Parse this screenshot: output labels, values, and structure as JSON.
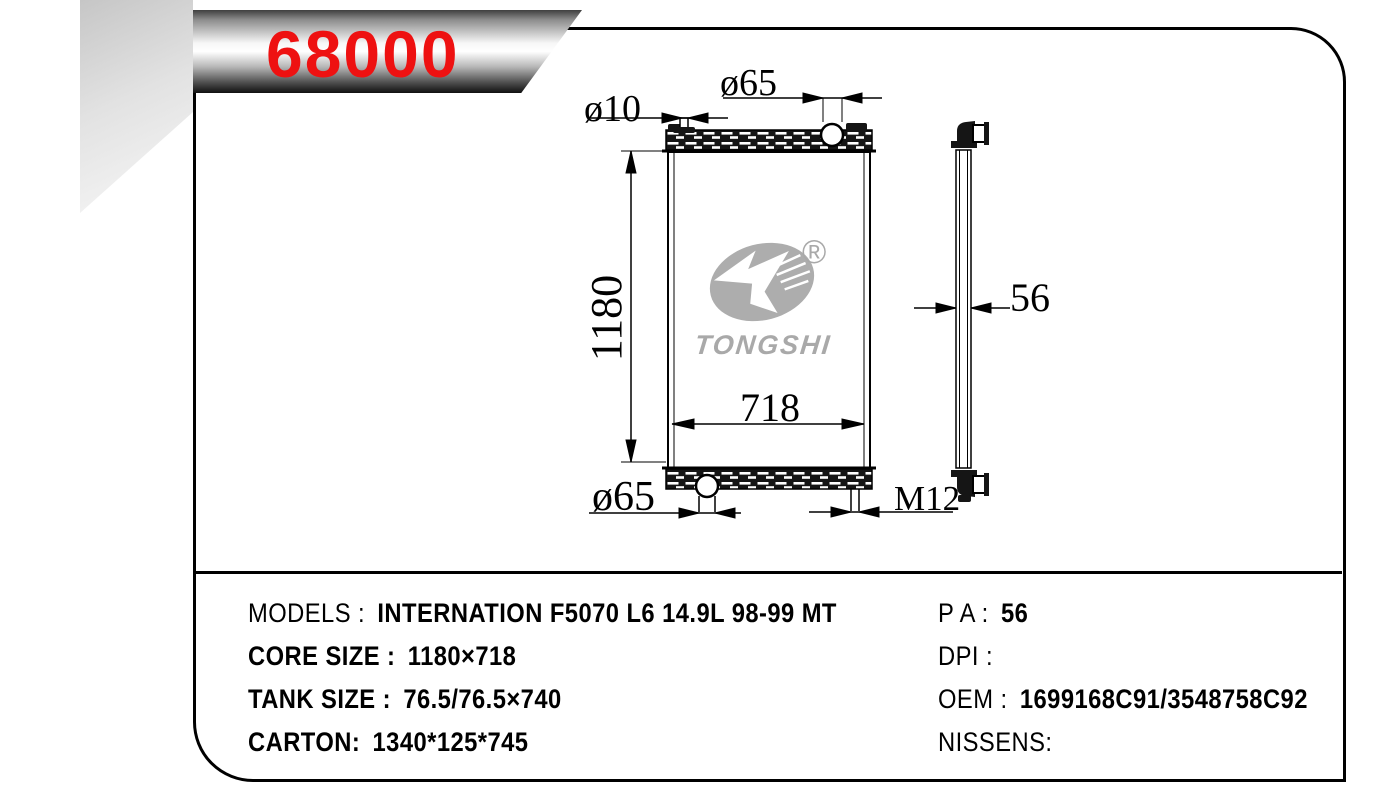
{
  "part_banner": {
    "number": "68000"
  },
  "corner_mark": {
    "letter": "T"
  },
  "logo": {
    "brand": "TONGSHI",
    "registered_mark": "®"
  },
  "drawing": {
    "front_view": {
      "top_inlet_diameter": "ø10",
      "filler_neck_diameter": "ø65",
      "core_height": "1180",
      "core_width": "718",
      "outlet_diameter": "ø65",
      "mounting_stud": "M12"
    },
    "side_view": {
      "thickness": "56"
    }
  },
  "specs": {
    "left": [
      {
        "label": "MODELS :",
        "value": "INTERNATION F5070 L6 14.9L 98-99 MT"
      },
      {
        "label": "CORE SIZE :",
        "value": "1180×718"
      },
      {
        "label": "TANK SIZE :",
        "value": "76.5/76.5×740"
      },
      {
        "label": "CARTON:",
        "value": "1340*125*745"
      }
    ],
    "right": [
      {
        "label": "P A :",
        "value": "56"
      },
      {
        "label": "DPI :",
        "value": ""
      },
      {
        "label": "OEM :",
        "value": "1699168C91/3548758C92"
      },
      {
        "label": "NISSENS:",
        "value": ""
      }
    ]
  }
}
